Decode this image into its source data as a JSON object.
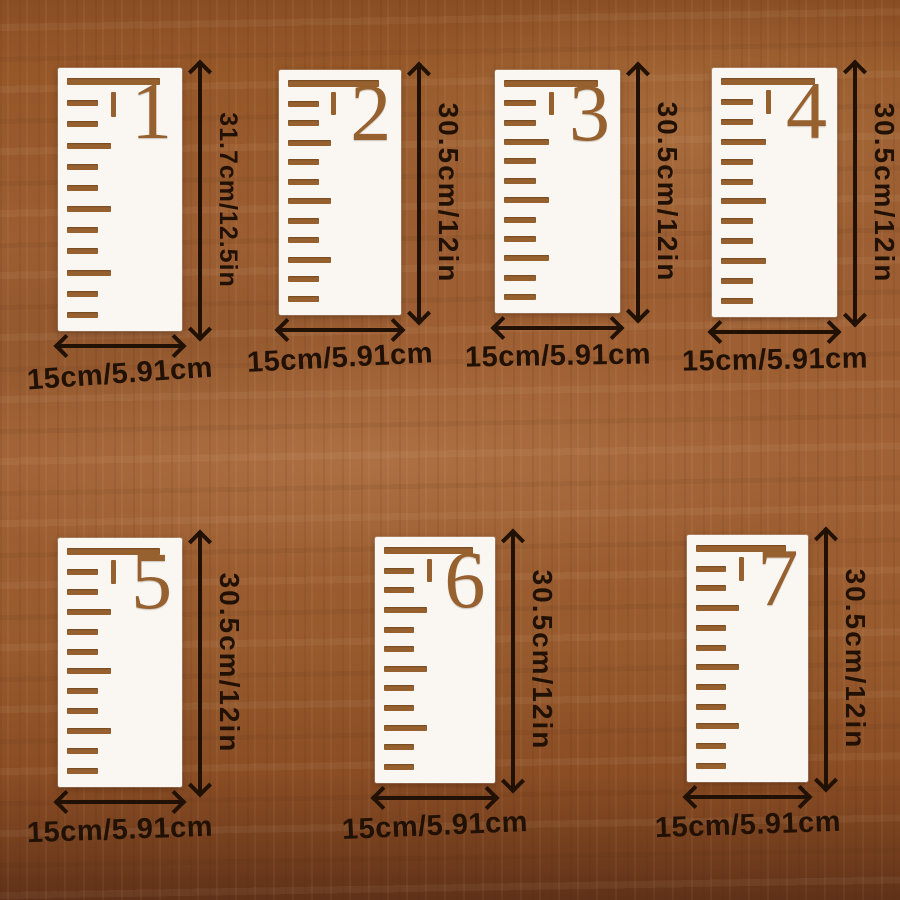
{
  "description": "Seven white wooden ruler growth-chart stencil variants laid on a wood table, each annotated with dimension arrows",
  "colors": {
    "wood_base": "#9b5c30",
    "wood_dark": "#6b3a1b",
    "card": "#faf7f2",
    "cutout": "#96602f",
    "ink": "#211104"
  },
  "ruler_design": {
    "tick_pattern": [
      "bar",
      "s",
      "s",
      "m",
      "s",
      "s",
      "m",
      "s",
      "s",
      "m",
      "s",
      "s"
    ]
  },
  "cards": [
    {
      "number": "1",
      "height_label": "31.7cm/12.5in",
      "width_label": "15cm/5.91cm"
    },
    {
      "number": "2",
      "height_label": "30.5cm/12in",
      "width_label": "15cm/5.91cm"
    },
    {
      "number": "3",
      "height_label": "30.5cm/12in",
      "width_label": "15cm/5.91cm"
    },
    {
      "number": "4",
      "height_label": "30.5cm/12in",
      "width_label": "15cm/5.91cm"
    },
    {
      "number": "5",
      "height_label": "30.5cm/12in",
      "width_label": "15cm/5.91cm"
    },
    {
      "number": "6",
      "height_label": "30.5cm/12in",
      "width_label": "15cm/5.91cm"
    },
    {
      "number": "7",
      "height_label": "30.5cm/12in",
      "width_label": "15cm/5.91cm"
    }
  ]
}
